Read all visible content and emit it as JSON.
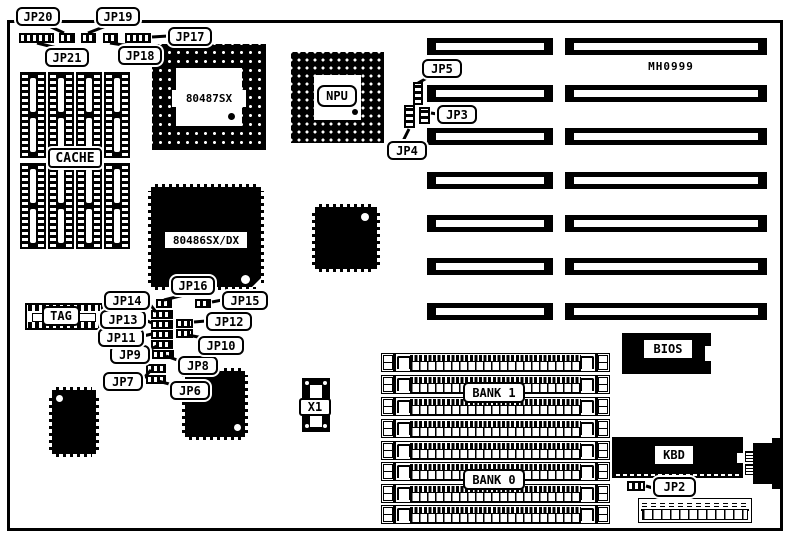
{
  "labels": {
    "board_code": "MH0999",
    "cache": "CACHE",
    "tag": "TAG",
    "copro_socket": "80487SX",
    "npu": "NPU",
    "cpu": "80486SX/DX",
    "crystal": "X1",
    "bank1": "BANK 1",
    "bank0": "BANK 0",
    "bios": "BIOS",
    "kbd": "KBD"
  },
  "jumpers": [
    {
      "id": "JP2",
      "box": [
        653,
        477,
        43,
        20
      ],
      "jump": [
        627,
        481,
        18,
        10
      ],
      "o": "h",
      "leader": [
        653,
        488,
        646,
        486
      ]
    },
    {
      "id": "JP3",
      "box": [
        437,
        105,
        40,
        19
      ],
      "jump": [
        419,
        107,
        11,
        17
      ],
      "o": "v",
      "leader": [
        437,
        114,
        431,
        113
      ]
    },
    {
      "id": "JP4",
      "box": [
        387,
        141,
        40,
        19
      ],
      "jump": [
        404,
        105,
        11,
        23
      ],
      "o": "v",
      "leader": [
        403,
        141,
        409,
        129
      ]
    },
    {
      "id": "JP5",
      "box": [
        422,
        59,
        40,
        19
      ],
      "jump": [
        413,
        82,
        10,
        23
      ],
      "o": "v",
      "leader": [
        427,
        78,
        418,
        83
      ]
    },
    {
      "id": "JP6",
      "box": [
        170,
        381,
        40,
        19
      ],
      "jump": [
        146,
        375,
        20,
        9
      ],
      "o": "h",
      "leader": [
        173,
        385,
        158,
        381
      ]
    },
    {
      "id": "JP7",
      "box": [
        103,
        372,
        40,
        19
      ],
      "jump": [
        146,
        364,
        20,
        9
      ],
      "o": "h",
      "leader": [
        143,
        379,
        151,
        370
      ]
    },
    {
      "id": "JP8",
      "box": [
        178,
        356,
        40,
        19
      ],
      "jump": [
        152,
        350,
        22,
        9
      ],
      "o": "h",
      "leader": [
        180,
        361,
        166,
        356
      ]
    },
    {
      "id": "JP9",
      "box": [
        110,
        345,
        40,
        19
      ],
      "jump": [
        151,
        340,
        22,
        9
      ],
      "o": "h",
      "leader": [
        149,
        350,
        157,
        346
      ]
    },
    {
      "id": "JP10",
      "box": [
        198,
        336,
        46,
        19
      ],
      "jump": [
        176,
        329,
        17,
        9
      ],
      "o": "h",
      "leader": [
        204,
        338,
        187,
        335
      ]
    },
    {
      "id": "JP11",
      "box": [
        98,
        328,
        46,
        19
      ],
      "jump": [
        151,
        330,
        22,
        9
      ],
      "o": "h",
      "leader": [
        143,
        336,
        152,
        334
      ]
    },
    {
      "id": "JP12",
      "box": [
        206,
        312,
        46,
        19
      ],
      "jump": [
        176,
        319,
        17,
        9
      ],
      "o": "h",
      "leader": [
        206,
        321,
        194,
        322
      ]
    },
    {
      "id": "JP13",
      "box": [
        100,
        310,
        46,
        19
      ],
      "jump": [
        151,
        320,
        22,
        9
      ],
      "o": "h",
      "leader": [
        145,
        320,
        152,
        323
      ]
    },
    {
      "id": "JP14",
      "box": [
        104,
        291,
        46,
        19
      ],
      "jump": [
        151,
        310,
        22,
        9
      ],
      "o": "h",
      "leader": [
        149,
        303,
        156,
        312
      ]
    },
    {
      "id": "JP15",
      "box": [
        222,
        291,
        46,
        19
      ],
      "jump": [
        195,
        299,
        16,
        9
      ],
      "o": "h",
      "leader": [
        222,
        300,
        212,
        302
      ]
    },
    {
      "id": "JP16",
      "box": [
        171,
        276,
        44,
        19
      ],
      "jump": [
        156,
        299,
        16,
        9
      ],
      "o": "h",
      "leader": [
        184,
        295,
        164,
        300
      ]
    },
    {
      "id": "JP17",
      "box": [
        168,
        27,
        44,
        19
      ],
      "jump": [
        125,
        33,
        26,
        10
      ],
      "o": "h",
      "leader": [
        168,
        36,
        152,
        37
      ]
    },
    {
      "id": "JP18",
      "box": [
        118,
        46,
        44,
        19
      ],
      "jump": [
        103,
        33,
        15,
        10
      ],
      "o": "h",
      "leader": [
        130,
        46,
        110,
        43
      ]
    },
    {
      "id": "JP19",
      "box": [
        96,
        7,
        44,
        19
      ],
      "jump": [
        81,
        33,
        15,
        10
      ],
      "o": "h",
      "leader": [
        106,
        26,
        88,
        33
      ]
    },
    {
      "id": "JP20",
      "box": [
        16,
        7,
        44,
        19
      ],
      "jump": [
        59,
        33,
        16,
        10
      ],
      "o": "h",
      "leader": [
        49,
        26,
        64,
        33
      ]
    },
    {
      "id": "JP21",
      "box": [
        45,
        48,
        44,
        19
      ],
      "jump": [
        19,
        33,
        35,
        10
      ],
      "o": "h",
      "leader": [
        57,
        48,
        37,
        43
      ]
    }
  ],
  "isa_slots": {
    "rows_y": [
      38,
      85,
      128,
      172,
      215,
      258,
      303
    ],
    "height": 17,
    "short_x": 427,
    "short_w": 126,
    "long_x": 565,
    "long_w": 202
  },
  "memory": {
    "x": 381,
    "w": 227,
    "height": 17,
    "rows_y": [
      353,
      375,
      397,
      419,
      441,
      462,
      484,
      505
    ]
  },
  "cache_chips": {
    "cols_x": [
      20,
      48,
      76,
      104
    ],
    "rows_y": [
      72,
      163
    ],
    "chip_w": 24,
    "chip_h": 84
  }
}
